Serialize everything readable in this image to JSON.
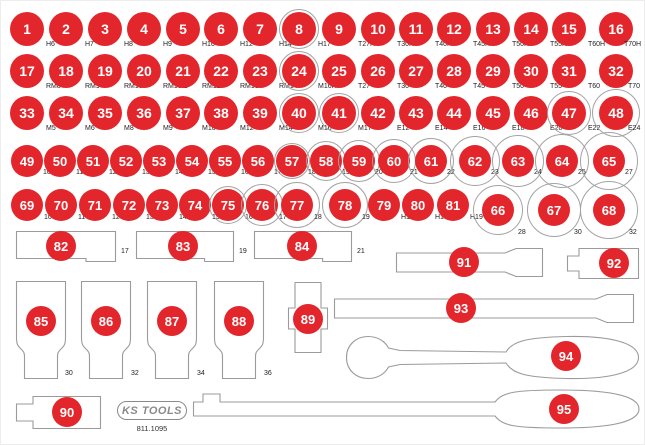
{
  "colors": {
    "red": "#e2262c",
    "ring": "#a3a3a3",
    "outline": "#9b9b9b",
    "label": "#222222",
    "number": "#ffffff"
  },
  "logo": {
    "brand": "KS TOOLS",
    "part_number": "811.1095"
  },
  "circle_rows": [
    {
      "y": 28,
      "d": 34,
      "fs": 14,
      "lox": 19,
      "loy": 12,
      "items": [
        {
          "n": "1",
          "x": 26,
          "label": "H6"
        },
        {
          "n": "2",
          "x": 65,
          "label": "H7"
        },
        {
          "n": "3",
          "x": 104,
          "label": "H8"
        },
        {
          "n": "4",
          "x": 143,
          "label": "H9"
        },
        {
          "n": "5",
          "x": 182,
          "label": "H10"
        },
        {
          "n": "6",
          "x": 220,
          "label": "H12"
        },
        {
          "n": "7",
          "x": 259,
          "label": "H14"
        },
        {
          "n": "8",
          "x": 298,
          "label": "H17",
          "ring": 40
        },
        {
          "n": "9",
          "x": 338,
          "label": "T27H"
        },
        {
          "n": "10",
          "x": 377,
          "label": "T30H"
        },
        {
          "n": "11",
          "x": 415,
          "label": "T40H"
        },
        {
          "n": "12",
          "x": 453,
          "label": "T45H"
        },
        {
          "n": "13",
          "x": 492,
          "label": "T50H"
        },
        {
          "n": "14",
          "x": 530,
          "label": "T55H"
        },
        {
          "n": "15",
          "x": 568,
          "label": "T60H"
        },
        {
          "n": "16",
          "x": 615,
          "label": "T70H",
          "lx": 8
        }
      ]
    },
    {
      "y": 70,
      "d": 34,
      "fs": 14,
      "lox": 19,
      "loy": 12,
      "items": [
        {
          "n": "17",
          "x": 26,
          "label": "RM8"
        },
        {
          "n": "18",
          "x": 65,
          "label": "RM9"
        },
        {
          "n": "19",
          "x": 104,
          "label": "RM10"
        },
        {
          "n": "20",
          "x": 143,
          "label": "RM10.1"
        },
        {
          "n": "21",
          "x": 182,
          "label": "RM12"
        },
        {
          "n": "22",
          "x": 220,
          "label": "RM13"
        },
        {
          "n": "23",
          "x": 259,
          "label": "RM14"
        },
        {
          "n": "24",
          "x": 298,
          "label": "M16H",
          "ring": 40
        },
        {
          "n": "25",
          "x": 338,
          "label": "T27"
        },
        {
          "n": "26",
          "x": 377,
          "label": "T30"
        },
        {
          "n": "27",
          "x": 415,
          "label": "T40"
        },
        {
          "n": "28",
          "x": 453,
          "label": "T45"
        },
        {
          "n": "29",
          "x": 492,
          "label": "T50"
        },
        {
          "n": "30",
          "x": 530,
          "label": "T55"
        },
        {
          "n": "31",
          "x": 568,
          "label": "T60"
        },
        {
          "n": "32",
          "x": 615,
          "label": "T70",
          "lx": 12
        }
      ]
    },
    {
      "y": 112,
      "d": 34,
      "fs": 14,
      "lox": 19,
      "loy": 12,
      "items": [
        {
          "n": "33",
          "x": 26,
          "label": "M5"
        },
        {
          "n": "34",
          "x": 65,
          "label": "M6"
        },
        {
          "n": "35",
          "x": 104,
          "label": "M8"
        },
        {
          "n": "36",
          "x": 143,
          "label": "M9"
        },
        {
          "n": "37",
          "x": 182,
          "label": "M10"
        },
        {
          "n": "38",
          "x": 220,
          "label": "M12"
        },
        {
          "n": "39",
          "x": 259,
          "label": "M14"
        },
        {
          "n": "40",
          "x": 298,
          "label": "M16",
          "ring": 40
        },
        {
          "n": "41",
          "x": 338,
          "label": "M17",
          "ring": 40
        },
        {
          "n": "42",
          "x": 377,
          "label": "E12"
        },
        {
          "n": "43",
          "x": 415,
          "label": "E14"
        },
        {
          "n": "44",
          "x": 453,
          "label": "E16"
        },
        {
          "n": "45",
          "x": 492,
          "label": "E18"
        },
        {
          "n": "46",
          "x": 530,
          "label": "E20"
        },
        {
          "n": "47",
          "x": 568,
          "label": "E22",
          "ring": 44
        },
        {
          "n": "48",
          "x": 615,
          "label": "E24",
          "ring": 48,
          "lx": 12
        }
      ]
    },
    {
      "y": 160,
      "d": 32,
      "fs": 13,
      "lox": 16,
      "loy": 8,
      "items": [
        {
          "n": "49",
          "x": 26,
          "label": "10"
        },
        {
          "n": "50",
          "x": 59,
          "label": "11"
        },
        {
          "n": "51",
          "x": 92,
          "label": "12"
        },
        {
          "n": "52",
          "x": 125,
          "label": "13"
        },
        {
          "n": "53",
          "x": 158,
          "label": "14"
        },
        {
          "n": "54",
          "x": 191,
          "label": "15"
        },
        {
          "n": "55",
          "x": 224,
          "label": "16"
        },
        {
          "n": "56",
          "x": 257,
          "label": "17"
        },
        {
          "n": "57",
          "x": 291,
          "label": "18",
          "ring": 36
        },
        {
          "n": "58",
          "x": 325,
          "label": "19",
          "ring": 40
        },
        {
          "n": "59",
          "x": 358,
          "label": "20",
          "ring": 42
        },
        {
          "n": "60",
          "x": 393,
          "label": "21",
          "ring": 44
        },
        {
          "n": "61",
          "x": 430,
          "label": "22",
          "ring": 46
        },
        {
          "n": "62",
          "x": 474,
          "label": "23",
          "ring": 50
        },
        {
          "n": "63",
          "x": 517,
          "label": "24",
          "ring": 52
        },
        {
          "n": "64",
          "x": 561,
          "label": "25",
          "ring": 54
        },
        {
          "n": "65",
          "x": 608,
          "label": "27",
          "ring": 58
        }
      ]
    },
    {
      "y": 204,
      "d": 32,
      "fs": 13,
      "lox": 17,
      "loy": 9,
      "items": [
        {
          "n": "69",
          "x": 26,
          "label": "10"
        },
        {
          "n": "70",
          "x": 60,
          "label": "11"
        },
        {
          "n": "71",
          "x": 94,
          "label": "12"
        },
        {
          "n": "72",
          "x": 128,
          "label": "13"
        },
        {
          "n": "73",
          "x": 161,
          "label": "14"
        },
        {
          "n": "74",
          "x": 194,
          "label": "15"
        },
        {
          "n": "75",
          "x": 227,
          "label": "16",
          "ring": 38
        },
        {
          "n": "76",
          "x": 261,
          "label": "17",
          "ring": 42
        },
        {
          "n": "77",
          "x": 296,
          "label": "18",
          "ring": 46
        },
        {
          "n": "78",
          "x": 344,
          "label": "19",
          "ring": 46
        },
        {
          "n": "79",
          "x": 383,
          "label": "H14"
        },
        {
          "n": "80",
          "x": 417,
          "label": "H17"
        },
        {
          "n": "81",
          "x": 452,
          "label": "H19"
        }
      ]
    },
    {
      "y": 209,
      "d": 32,
      "fs": 13,
      "lox": 20,
      "loy": 19,
      "items": [
        {
          "n": "66",
          "x": 497,
          "label": "28",
          "ring": 50
        },
        {
          "n": "67",
          "x": 553,
          "label": "30",
          "ring": 54
        },
        {
          "n": "68",
          "x": 608,
          "label": "32",
          "ring": 58
        }
      ]
    }
  ],
  "trays": [
    {
      "n": "82",
      "shape": "rect-step",
      "x": 15,
      "y": 230,
      "w": 100,
      "h": 31,
      "cx": 60,
      "cy": 245,
      "label": "17",
      "lx": 120,
      "ly": 247
    },
    {
      "n": "83",
      "shape": "rect-step",
      "x": 135,
      "y": 230,
      "w": 98,
      "h": 31,
      "cx": 182,
      "cy": 245,
      "label": "19",
      "lx": 238,
      "ly": 247
    },
    {
      "n": "84",
      "shape": "rect-step",
      "x": 253,
      "y": 230,
      "w": 98,
      "h": 31,
      "cx": 301,
      "cy": 245,
      "label": "21",
      "lx": 356,
      "ly": 247
    },
    {
      "n": "85",
      "shape": "socket",
      "x": 15,
      "y": 280,
      "w": 50,
      "h": 98,
      "cx": 40,
      "cy": 320,
      "label": "30",
      "lx": 64,
      "ly": 369
    },
    {
      "n": "86",
      "shape": "socket",
      "x": 80,
      "y": 280,
      "w": 50,
      "h": 98,
      "cx": 105,
      "cy": 320,
      "label": "32",
      "lx": 130,
      "ly": 369
    },
    {
      "n": "87",
      "shape": "socket",
      "x": 146,
      "y": 280,
      "w": 50,
      "h": 98,
      "cx": 171,
      "cy": 320,
      "label": "34",
      "lx": 196,
      "ly": 369
    },
    {
      "n": "88",
      "shape": "socket",
      "x": 213,
      "y": 280,
      "w": 50,
      "h": 98,
      "cx": 238,
      "cy": 320,
      "label": "36",
      "lx": 263,
      "ly": 369
    },
    {
      "n": "89",
      "shape": "joint",
      "x": 287,
      "y": 281,
      "w": 40,
      "h": 71,
      "cx": 307,
      "cy": 318
    },
    {
      "n": "90",
      "shape": "adapter",
      "x": 15,
      "y": 395,
      "w": 85,
      "h": 33,
      "cx": 66,
      "cy": 411
    },
    {
      "n": "91",
      "shape": "ext-bar",
      "x": 395,
      "y": 247,
      "w": 147,
      "h": 29,
      "cx": 463,
      "cy": 261
    },
    {
      "n": "92",
      "shape": "adapter-sm",
      "x": 566,
      "y": 247,
      "w": 72,
      "h": 31,
      "cx": 613,
      "cy": 262
    },
    {
      "n": "93",
      "shape": "ext-bar",
      "x": 333,
      "y": 293,
      "w": 300,
      "h": 29,
      "cx": 460,
      "cy": 307
    },
    {
      "n": "94",
      "shape": "ratchet",
      "x": 343,
      "y": 334,
      "w": 297,
      "h": 45,
      "cx": 565,
      "cy": 355
    },
    {
      "n": "95",
      "shape": "breaker",
      "x": 192,
      "y": 386,
      "w": 448,
      "h": 44,
      "cx": 563,
      "cy": 408
    }
  ]
}
